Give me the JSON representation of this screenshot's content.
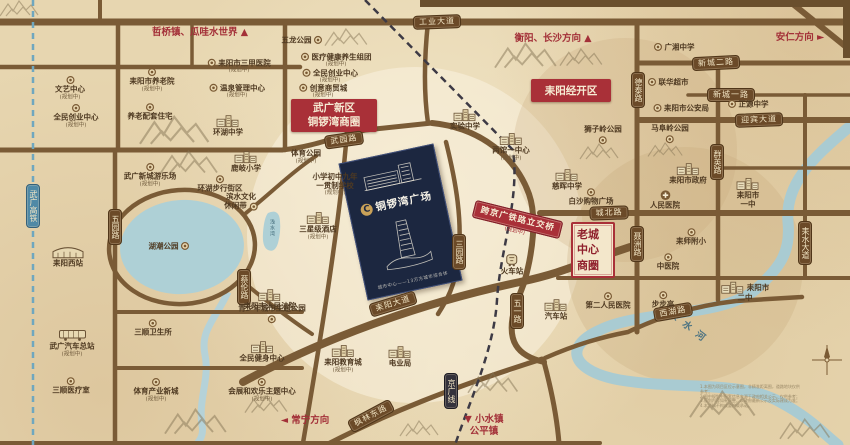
{
  "project": {
    "logo_letter": "C",
    "name": "铜锣湾广场",
    "caption": "城市中心——13万方城市综合体"
  },
  "districts": {
    "wuguang": {
      "line1": "武广新区",
      "line2": "铜锣湾商圈"
    },
    "jingkai": {
      "label": "耒阳经开区"
    },
    "laocheng": {
      "rows": [
        "老城",
        "中心",
        "商圈"
      ]
    }
  },
  "bridge": {
    "label": "跨京广铁路立交桥",
    "planned": "(规划中)"
  },
  "water": {
    "river_name": "耒水河",
    "pond_label": "浅水湾"
  },
  "directions": [
    {
      "t": "哲桥镇、瓜哇水世界",
      "a": "▲",
      "pos": "after",
      "x": 200,
      "y": 33
    },
    {
      "t": "衡阳、长沙方向",
      "a": "▲",
      "pos": "after",
      "x": 553,
      "y": 39
    },
    {
      "t": "安仁方向",
      "a": "►",
      "pos": "after",
      "x": 800,
      "y": 38
    },
    {
      "t": "常宁方向",
      "a": "◄",
      "pos": "before",
      "x": 305,
      "y": 421
    },
    {
      "t": "小水镇",
      "t2": "公平镇",
      "a": "▼",
      "pos": "before",
      "x": 484,
      "y": 426
    }
  ],
  "banners": [
    {
      "t": "工业大道",
      "x": 437,
      "y": 22,
      "r": -2,
      "v": false,
      "cls": ""
    },
    {
      "t": "武园路",
      "x": 344,
      "y": 140,
      "r": -8,
      "v": false,
      "cls": ""
    },
    {
      "t": "新城二路",
      "x": 716,
      "y": 63,
      "r": -3,
      "v": false,
      "cls": ""
    },
    {
      "t": "新城一路",
      "x": 731,
      "y": 95,
      "r": 0,
      "v": false,
      "cls": ""
    },
    {
      "t": "迎宾大道",
      "x": 759,
      "y": 120,
      "r": -2,
      "v": false,
      "cls": ""
    },
    {
      "t": "城北路",
      "x": 609,
      "y": 213,
      "r": -2,
      "v": false,
      "cls": ""
    },
    {
      "t": "耒阳大道",
      "x": 393,
      "y": 304,
      "r": -17,
      "v": false,
      "cls": ""
    },
    {
      "t": "西湖路",
      "x": 673,
      "y": 312,
      "r": -10,
      "v": false,
      "cls": ""
    },
    {
      "t": "枫林东路",
      "x": 371,
      "y": 416,
      "r": -28,
      "v": false,
      "cls": ""
    },
    {
      "t": "五一路",
      "x": 517,
      "y": 311,
      "r": 0,
      "v": true,
      "cls": ""
    },
    {
      "t": "五园路",
      "x": 115,
      "y": 227,
      "r": 0,
      "v": true,
      "cls": ""
    },
    {
      "t": "三园路",
      "x": 459,
      "y": 252,
      "r": 0,
      "v": true,
      "cls": ""
    },
    {
      "t": "德泰路",
      "x": 638,
      "y": 90,
      "r": 0,
      "v": true,
      "cls": ""
    },
    {
      "t": "聂洲路",
      "x": 637,
      "y": 244,
      "r": 0,
      "v": true,
      "cls": ""
    },
    {
      "t": "群英路",
      "x": 717,
      "y": 162,
      "r": 0,
      "v": true,
      "cls": ""
    },
    {
      "t": "耒水大道",
      "x": 805,
      "y": 243,
      "r": 0,
      "v": true,
      "cls": ""
    },
    {
      "t": "蔡伦路",
      "x": 244,
      "y": 287,
      "r": 0,
      "v": true,
      "cls": ""
    },
    {
      "t": "京广线",
      "x": 451,
      "y": 391,
      "r": 0,
      "v": true,
      "cls": "rail"
    },
    {
      "t": "武广高铁",
      "x": 33,
      "y": 206,
      "r": 0,
      "v": true,
      "cls": "hsr"
    }
  ],
  "pois": [
    {
      "t": "文艺中心",
      "x": 70,
      "y": 88,
      "ic": "med",
      "ip": "above",
      "p": true
    },
    {
      "t": "全民创业中心",
      "x": 76,
      "y": 116,
      "ic": "med",
      "ip": "above",
      "p": true
    },
    {
      "t": "耒阳市养老院",
      "x": 152,
      "y": 80,
      "ic": "med",
      "ip": "above",
      "p": true
    },
    {
      "t": "养老配套住宅",
      "x": 150,
      "y": 112,
      "ic": "med",
      "ip": "above",
      "p": false
    },
    {
      "t": "耒阳市三甲医院",
      "x": 239,
      "y": 66,
      "ic": "med",
      "ip": "left",
      "p": true
    },
    {
      "t": "温泉管理中心",
      "x": 237,
      "y": 91,
      "ic": "med",
      "ip": "left",
      "p": true
    },
    {
      "t": "环湖中学",
      "x": 228,
      "y": 126,
      "ic": "bldg",
      "ip": "above",
      "p": false
    },
    {
      "t": "五龙公园",
      "x": 302,
      "y": 40,
      "ic": "med",
      "ip": "right",
      "p": false
    },
    {
      "t": "医疗健康养生组团",
      "x": 336,
      "y": 60,
      "ic": "med",
      "ip": "left",
      "p": true
    },
    {
      "t": "全民创业中心",
      "x": 330,
      "y": 76,
      "ic": "med",
      "ip": "left",
      "p": true
    },
    {
      "t": "创意商贸城",
      "x": 323,
      "y": 91,
      "ic": "med",
      "ip": "left",
      "p": true
    },
    {
      "t": "武广新城游乐场",
      "x": 150,
      "y": 175,
      "ic": "med",
      "ip": "above",
      "p": true
    },
    {
      "t": "鹿岐小学",
      "x": 246,
      "y": 162,
      "ic": "bldg",
      "ip": "above",
      "p": false
    },
    {
      "t": "环湖步行街区",
      "x": 220,
      "y": 184,
      "ic": "med",
      "ip": "above",
      "p": false
    },
    {
      "t": "滨水文化",
      "t2": "休闲带",
      "x": 241,
      "y": 202,
      "ic": "med",
      "ip": "right",
      "p": false
    },
    {
      "t": "湖潮公园",
      "x": 169,
      "y": 246,
      "ic": "med",
      "ip": "right",
      "p": false
    },
    {
      "t": "耒阳西站",
      "x": 68,
      "y": 256,
      "ic": "station",
      "ip": "above",
      "p": false
    },
    {
      "t": "体育公园",
      "x": 306,
      "y": 157,
      "ic": "",
      "ip": "",
      "p": true
    },
    {
      "t": "小学初中九年",
      "t2": "一贯制学校",
      "x": 335,
      "y": 185,
      "ic": "",
      "ip": "",
      "p": true
    },
    {
      "t": "三星级酒店",
      "x": 318,
      "y": 226,
      "ic": "bldg",
      "ip": "above",
      "p": true
    },
    {
      "t": "实验中学",
      "x": 465,
      "y": 120,
      "ic": "bldg",
      "ip": "above",
      "p": false
    },
    {
      "t": "两馆一中心",
      "x": 511,
      "y": 147,
      "ic": "bldg",
      "ip": "above",
      "p": true
    },
    {
      "t": "广湘中学",
      "x": 674,
      "y": 47,
      "ic": "med",
      "ip": "left",
      "p": false
    },
    {
      "t": "联华超市",
      "x": 668,
      "y": 82,
      "ic": "med",
      "ip": "left",
      "p": false
    },
    {
      "t": "耒阳市公安局",
      "x": 681,
      "y": 108,
      "ic": "med",
      "ip": "left",
      "p": false
    },
    {
      "t": "正源中学",
      "x": 748,
      "y": 104,
      "ic": "med",
      "ip": "left",
      "p": false
    },
    {
      "t": "狮子岭公园",
      "x": 603,
      "y": 135,
      "ic": "med",
      "ip": "below",
      "p": false
    },
    {
      "t": "马阜岭公园",
      "x": 670,
      "y": 134,
      "ic": "med",
      "ip": "below",
      "p": false
    },
    {
      "t": "慈晖中学",
      "x": 567,
      "y": 180,
      "ic": "bldg",
      "ip": "above",
      "p": false
    },
    {
      "t": "白沙购物广场",
      "x": 591,
      "y": 197,
      "ic": "med",
      "ip": "above",
      "p": false
    },
    {
      "t": "耒阳市政府",
      "x": 688,
      "y": 174,
      "ic": "bldg",
      "ip": "above",
      "p": false
    },
    {
      "t": "人民医院",
      "x": 665,
      "y": 200,
      "ic": "hosp",
      "ip": "above",
      "p": false
    },
    {
      "t": "耒阳市",
      "t2": "一中",
      "x": 748,
      "y": 193,
      "ic": "bldg",
      "ip": "above",
      "p": false
    },
    {
      "t": "耒师附小",
      "x": 691,
      "y": 237,
      "ic": "med",
      "ip": "above",
      "p": false
    },
    {
      "t": "中医院",
      "x": 668,
      "y": 262,
      "ic": "med",
      "ip": "above",
      "p": false
    },
    {
      "t": "第二人民医院",
      "x": 608,
      "y": 301,
      "ic": "med",
      "ip": "above",
      "p": false
    },
    {
      "t": "步步高",
      "x": 663,
      "y": 300,
      "ic": "med",
      "ip": "above",
      "p": false
    },
    {
      "t": "耒阳市",
      "t2": "二中",
      "x": 745,
      "y": 292,
      "ic": "bldg",
      "ip": "left",
      "p": false
    },
    {
      "t": "火车站",
      "x": 512,
      "y": 265,
      "ic": "train",
      "ip": "above",
      "p": false
    },
    {
      "t": "汽车站",
      "x": 556,
      "y": 310,
      "ic": "bldg",
      "ip": "above",
      "p": false
    },
    {
      "t": "耒阳教育城",
      "x": 343,
      "y": 359,
      "ic": "bldg",
      "ip": "above",
      "p": true
    },
    {
      "t": "电业局",
      "x": 400,
      "y": 357,
      "ic": "bldg",
      "ip": "above",
      "p": false
    },
    {
      "t": "耒阳市人民法院",
      "x": 270,
      "y": 300,
      "ic": "bldg",
      "ip": "above",
      "p": false
    },
    {
      "t": "青少年城市主题公园",
      "x": 272,
      "y": 314,
      "ic": "med",
      "ip": "below",
      "p": false
    },
    {
      "t": "全民健身中心",
      "x": 262,
      "y": 352,
      "ic": "bldg",
      "ip": "above",
      "p": false
    },
    {
      "t": "会展和欢乐主题中心",
      "x": 262,
      "y": 390,
      "ic": "med",
      "ip": "above",
      "p": true
    },
    {
      "t": "三顺卫生所",
      "x": 153,
      "y": 328,
      "ic": "med",
      "ip": "above",
      "p": false
    },
    {
      "t": "体育产业新城",
      "x": 156,
      "y": 390,
      "ic": "med",
      "ip": "above",
      "p": true
    },
    {
      "t": "武广汽车总站",
      "x": 72,
      "y": 343,
      "ic": "bus",
      "ip": "above",
      "p": true
    },
    {
      "t": "三顺医疗室",
      "x": 71,
      "y": 386,
      "ic": "med",
      "ip": "above",
      "p": false
    }
  ],
  "planned_suffix": "(规划中)",
  "disclaimer": [
    "1.本图为项目区位示意图，非精准距离图，道路地块仅供参考；",
    "2.图中规划中配套信息来源于政府相关公示，仅供参考；",
    "3.规划内容如有调整，以政府最新公示及实际建成为准；",
    "4.本资料不构成要约或承诺。"
  ]
}
